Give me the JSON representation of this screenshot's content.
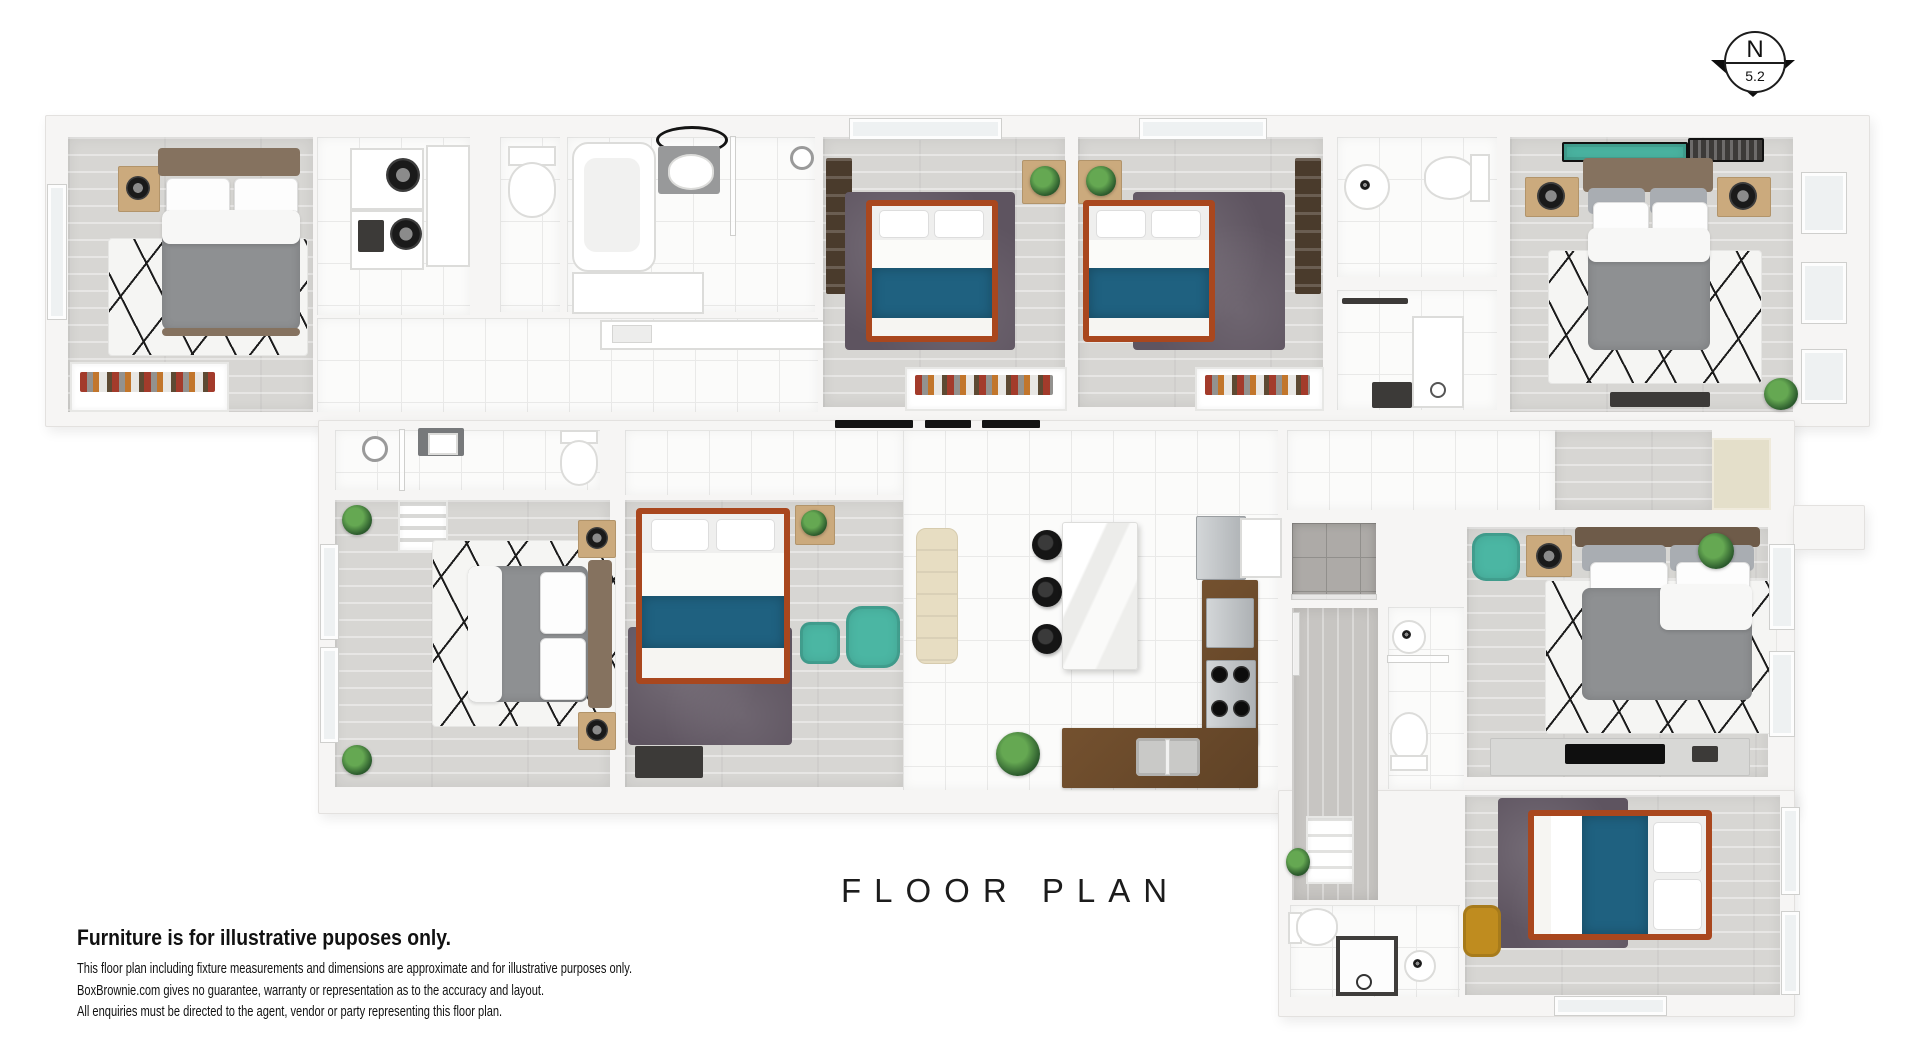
{
  "title": "FLOOR PLAN",
  "compass": {
    "letter": "N",
    "bearing": "5.2"
  },
  "disclaimer": {
    "heading": "Furniture is for illustrative puposes only.",
    "lines": [
      "This floor plan including fixture measurements and dimensions are approximate and for illustrative purposes only.",
      "BoxBrownie.com gives no guarantee, warranty or representation as to the accuracy and layout.",
      "All enquiries must be directed to the agent, vendor or party representing this floor plan."
    ]
  },
  "palette": {
    "wall": "#f6f5f4",
    "floor-wood": "#d7d6d3",
    "floor-tile": "#fbfbfa",
    "bed-blue": "#1f6180",
    "bed-frame": "#a9471e",
    "rug-purple": "#5e5460",
    "teal": "#4bb6a3",
    "counter-wood": "#74512f",
    "mustard": "#bf8c1f",
    "duvet-gray": "#8e9092",
    "headboard-brown": "#85725f"
  }
}
